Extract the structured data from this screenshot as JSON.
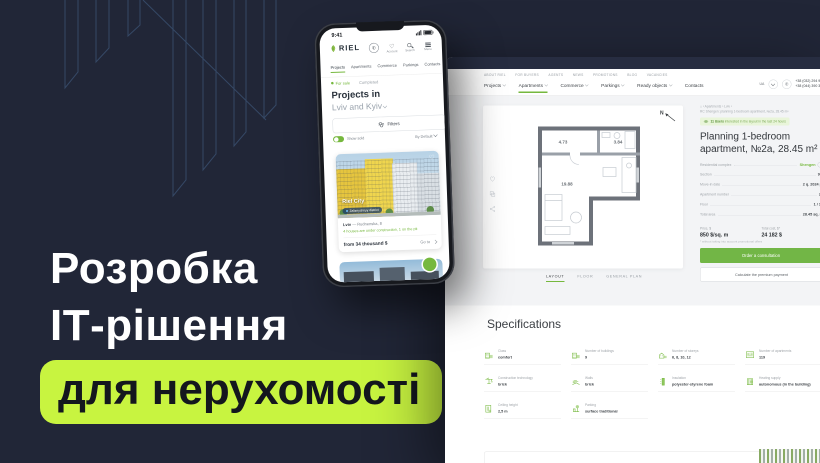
{
  "hero": {
    "line1": "Розробка",
    "line2": "ІТ-рішення",
    "highlight": "для нерухомості",
    "accent_color": "#c8f440",
    "background_color": "#212637"
  },
  "phone": {
    "time": "9:41",
    "logo": "RIEL",
    "icon_labels": {
      "account": "Account",
      "search": "Search",
      "menu": "Menu"
    },
    "nav": [
      "Projects",
      "Apartments",
      "Commerce",
      "Parkings",
      "Contacts"
    ],
    "filter_for_sale": "For sale",
    "filter_completed": "Completed",
    "heading": "Projects in",
    "subheading": "Lviv and Kyiv",
    "filters_button": "Filters",
    "show_toggle": "Show sold",
    "sort_by": "By Default",
    "card": {
      "name": "Riel City",
      "district": "Zaliznychnyy district",
      "city": "Lviv",
      "address": "— Rudnenska, 8",
      "status": "4 houses are under construction, 1 on the pit",
      "price": "from 34 thousand $",
      "go_to": "Go to"
    }
  },
  "site": {
    "accent_color": "#76b83e",
    "top_links": [
      "ABOUT RIEL",
      "FOR BUYERS",
      "AGENTS",
      "NEWS",
      "PROMOTIONS",
      "BLOG",
      "VACANCIES"
    ],
    "nav": [
      "Projects",
      "Apartments",
      "Commerce",
      "Parkings",
      "Ready objects",
      "Contacts"
    ],
    "lang": "UA",
    "phone1": "+38 (032) 294 94 94",
    "phone2": "+38 (044) 390 30 30",
    "breadcrumb": "›  Apartments  ›  Lviv  ›",
    "breadcrumb_page": "RC Shengen: planning 1-bedroom apartment, №2a, 28.45 m²",
    "notice_strong": "11 Users",
    "notice_rest": "interested in the layout in the last 24 hours",
    "title": "Planning 1-bedroom apartment, №2a, 28.45 m²",
    "details": [
      {
        "label": "Residential complex",
        "value": "Shengen"
      },
      {
        "label": "Section",
        "value": "9.2"
      },
      {
        "label": "Move-in date",
        "value": "2 q. 2024 p."
      },
      {
        "label": "Apartment number",
        "value": "2a"
      },
      {
        "label": "Floor",
        "value": "1 / 10"
      },
      {
        "label": "Total area",
        "value": "28.45 sq. m"
      }
    ],
    "price_label": "Price, $",
    "price_value": "850 $/sq. m",
    "total_label": "Total cost, $*",
    "total_value": "24 182 $",
    "price_note": "* without taking into account promotional offers",
    "cta_primary": "Order a consultation",
    "cta_secondary": "Calculate the premium payment",
    "plan": {
      "compass": "N",
      "tabs": [
        "LAYOUT",
        "FLOOR",
        "GENERAL PLAN"
      ],
      "rooms": [
        "4.73",
        "3.84",
        "19.88"
      ]
    },
    "specs_title": "Specifications",
    "specs": [
      {
        "label": "Class",
        "value": "comfort"
      },
      {
        "label": "Number of buildings",
        "value": "9"
      },
      {
        "label": "Number of storeys",
        "value": "6, 8, 10, 12"
      },
      {
        "label": "Number of apartments",
        "value": "119"
      },
      {
        "label": "Construction technology",
        "value": "brick"
      },
      {
        "label": "Walls",
        "value": "brick"
      },
      {
        "label": "Insulation",
        "value": "polyester-styrene foam"
      },
      {
        "label": "Heating supply",
        "value": "autonomous (in the building)"
      },
      {
        "label": "Ceiling height",
        "value": "2,5 m"
      },
      {
        "label": "Parking",
        "value": "surface traditional"
      }
    ]
  }
}
